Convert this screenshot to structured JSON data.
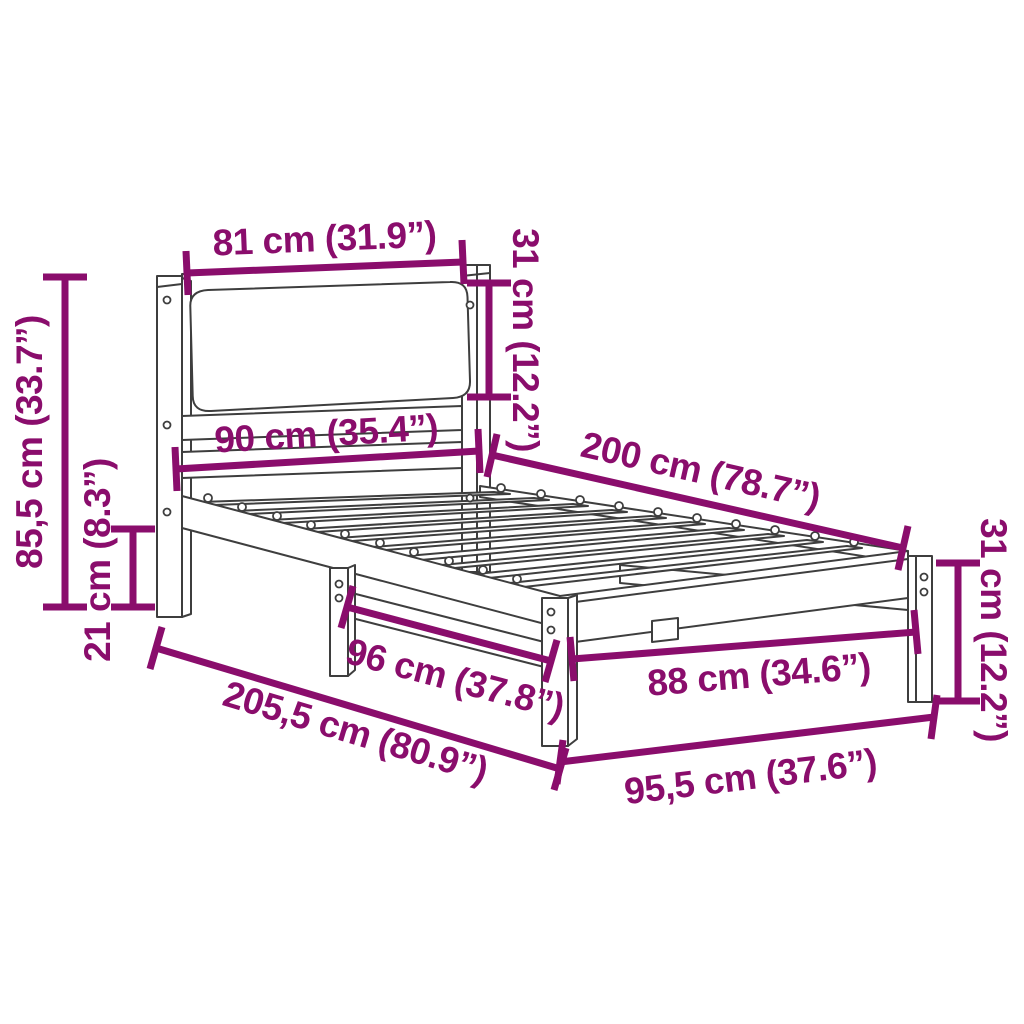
{
  "meta": {
    "type": "product-dimension-diagram",
    "subject": "wooden bed frame with upholstered headboard and slatted base",
    "background": "#ffffff"
  },
  "colors": {
    "dimension": "#8a0d6c",
    "frame_outline": "#3e3e3e"
  },
  "dimensions": {
    "headboard_width": "81 cm (31.9”)",
    "headboard_panel_height": "31 cm (12.2”)",
    "bed_width_headboard": "90 cm (35.4”)",
    "bed_length": "200 cm (78.7”)",
    "headboard_total_height": "85,5 cm (33.7”)",
    "underbed_clearance": "21 cm (8.3”)",
    "side_rail_length": "96 cm (37.8”)",
    "foot_inner_width": "88 cm (34.6”)",
    "total_length": "205,5 cm (80.9”)",
    "total_width_foot": "95,5 cm (37.6”)",
    "foot_end_height": "31 cm (12.2”)"
  }
}
